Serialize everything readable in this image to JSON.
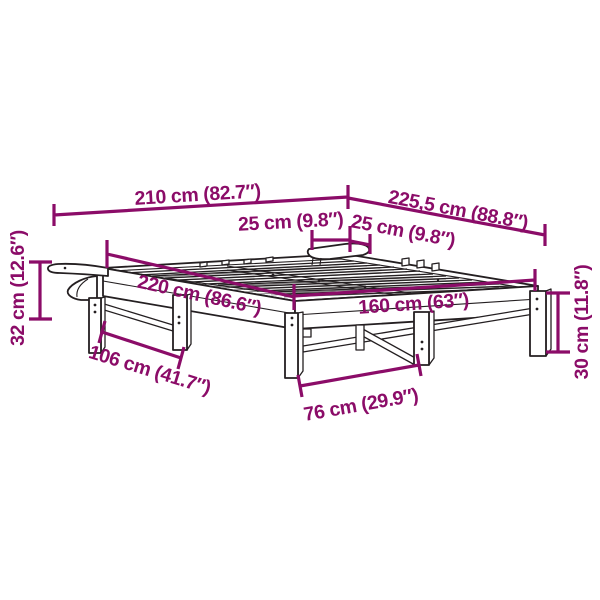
{
  "diagram": {
    "type": "furniture-dimension-diagram",
    "subject": "slatted bed frame with wall brackets, isometric line drawing",
    "background_color": "#ffffff",
    "dimension_color": "#8B0C68",
    "drawing_color": "#241F21",
    "dimensions": [
      {
        "id": "overall-length",
        "text": "210 cm (82.7″)",
        "orientation": "top horizontal"
      },
      {
        "id": "overall-diagonal",
        "text": "225,5 cm (88.8″)",
        "orientation": "top angled right"
      },
      {
        "id": "bracket-depth",
        "text": "25 cm (9.8″)",
        "orientation": "center horizontal"
      },
      {
        "id": "bracket-width",
        "text": "25 cm (9.8″)",
        "orientation": "center angled right"
      },
      {
        "id": "frame-length",
        "text": "220 cm (86.6″)",
        "orientation": "across bed surface"
      },
      {
        "id": "frame-width",
        "text": "160 cm (63″)",
        "orientation": "across bed front"
      },
      {
        "id": "bracket-height",
        "text": "32 cm (12.6″)",
        "orientation": "left vertical"
      },
      {
        "id": "side-leg-spacing",
        "text": "106 cm (41.7″)",
        "orientation": "lower-left angled"
      },
      {
        "id": "front-leg-spacing",
        "text": "76 cm (29.9″)",
        "orientation": "bottom angled"
      },
      {
        "id": "leg-height",
        "text": "30 cm (11.8″)",
        "orientation": "right vertical"
      }
    ]
  }
}
